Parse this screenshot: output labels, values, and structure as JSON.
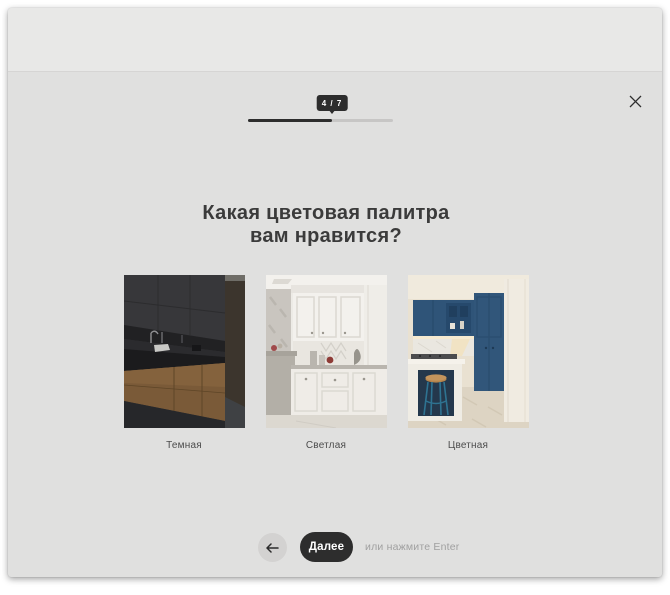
{
  "modal": {
    "close_icon": "x-icon"
  },
  "progress": {
    "badge": "4 / 7",
    "current": 4,
    "total": 7,
    "fill_style": "width:57.9%"
  },
  "question": {
    "line1": "Какая цветовая палитра",
    "line2": "вам нравится?"
  },
  "options": [
    {
      "label": "Темная",
      "photo": "dark-kitchen"
    },
    {
      "label": "Светлая",
      "photo": "light-kitchen"
    },
    {
      "label": "Цветная",
      "photo": "blue-kitchen"
    }
  ],
  "footer": {
    "back_icon": "arrow-left-icon",
    "next_label": "Далее",
    "enter_hint": "или нажмите Enter"
  },
  "colors": {
    "page_bg": "#ffffff",
    "topbar_bg": "#e8e8e7",
    "modal_bg": "#e0e0df",
    "accent_dark": "#2d2d2d",
    "track": "#c7c6c5",
    "text_dark": "#3b3b3b",
    "text_muted": "#a0a0a0"
  }
}
